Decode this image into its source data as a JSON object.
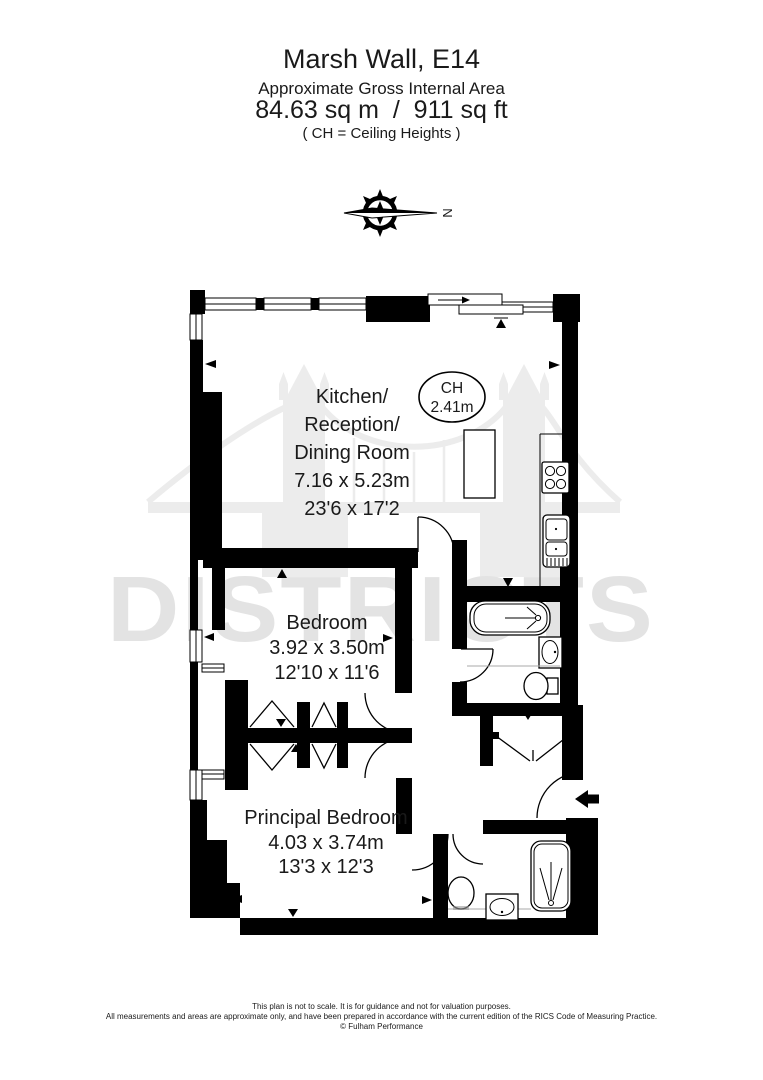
{
  "header": {
    "title": "Marsh Wall, E14",
    "subtitle": "Approximate Gross Internal Area",
    "area": "84.63 sq m  /  911 sq ft",
    "ch_note": "( CH = Ceiling Heights )"
  },
  "compass": {
    "north_label": "N"
  },
  "watermark": {
    "brand": "DISTRICTS"
  },
  "plan": {
    "kitchen": {
      "line1": "Kitchen/",
      "line2": "Reception/",
      "line3": "Dining Room",
      "metric": "7.16 x 5.23m",
      "imperial": "23'6 x 17'2"
    },
    "ceiling_badge": {
      "label": "CH",
      "value": "2.41m"
    },
    "bedroom": {
      "name": "Bedroom",
      "metric": "3.92 x 3.50m",
      "imperial": "12'10 x 11'6"
    },
    "principal_bedroom": {
      "name": "Principal Bedroom",
      "metric": "4.03 x 3.74m",
      "imperial": "13'3 x 12'3"
    }
  },
  "footer": {
    "line1": "This plan is not to scale. It is for guidance and not for valuation purposes.",
    "line2": "All measurements and areas are approximate only, and have been prepared in accordance with the current edition of the RICS Code of Measuring Practice.",
    "line3": "© Fulham Performance"
  },
  "colors": {
    "wall": "#000000",
    "watermark_gray": "#e3e3e3",
    "bridge_gray": "#ececec"
  }
}
